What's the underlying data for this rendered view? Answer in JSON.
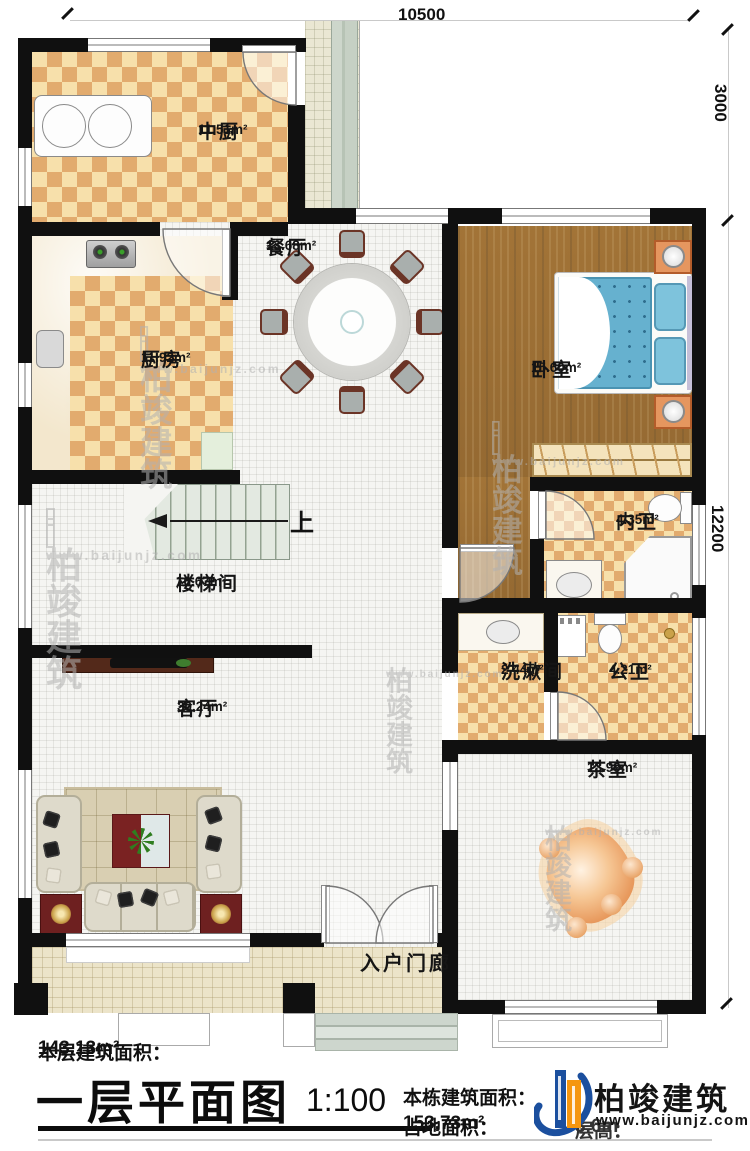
{
  "dimensions": {
    "width_top": "10500",
    "height_upper_right": "3000",
    "height_lower_right": "12200"
  },
  "rooms": {
    "chinese_kitchen": {
      "name": "中厨",
      "area": "11.51m²"
    },
    "dining": {
      "name": "餐厅",
      "area": "13.68m²"
    },
    "kitchen": {
      "name": "厨房",
      "area": "11.92m²"
    },
    "bedroom": {
      "name": "卧室",
      "area": "15.60m²"
    },
    "ensuite_bath": {
      "name": "内卫",
      "area": "4.35m²"
    },
    "stairwell": {
      "name": "楼梯间",
      "area": "16.67m²"
    },
    "washroom": {
      "name": "洗漱间",
      "area": "2.44m²"
    },
    "public_bath": {
      "name": "公卫",
      "area": "4.21m²"
    },
    "living": {
      "name": "客厅",
      "area": "30.24m²"
    },
    "tea_room": {
      "name": "茶室",
      "area": "13.99m²"
    },
    "entry_porch": {
      "name": "入户门廊"
    }
  },
  "stairs": {
    "direction_label": "上"
  },
  "footer": {
    "floor_area_label": "本层建筑面积：",
    "floor_area_value": "143.13m²",
    "title": "一层平面图",
    "scale": "1:100",
    "building_area_label": "本栋建筑面积：",
    "site_area_label": "占地面积：",
    "site_area_value": "153.73m²",
    "floor_height_label": "层高：",
    "floor_height_value": "3.6m"
  },
  "logo": {
    "company": "柏竣建筑",
    "website": "www.baijunjz.com",
    "brand_blue": "#1b4f9e",
    "brand_orange": "#f5960f"
  },
  "watermark": {
    "text": "柏竣建筑",
    "subtext": "www.baijunjz.com"
  }
}
